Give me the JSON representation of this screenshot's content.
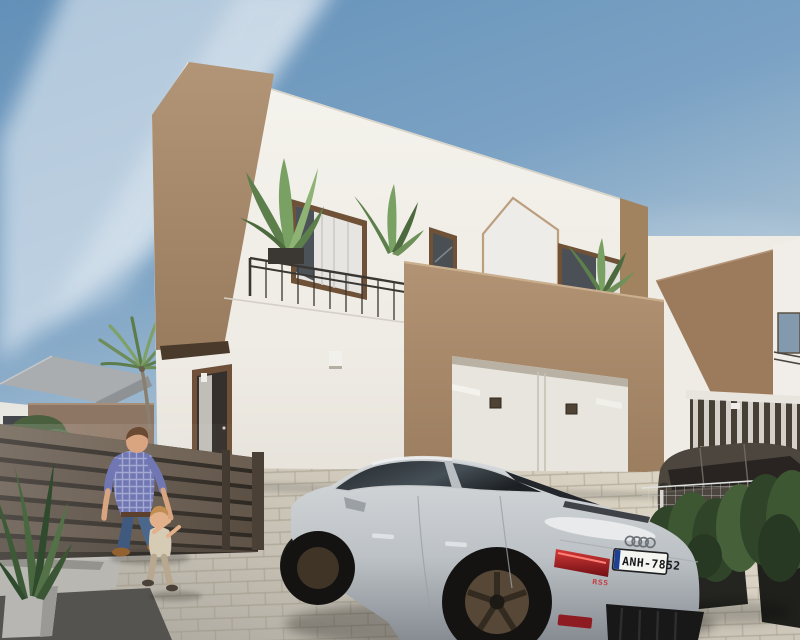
{
  "meta": {
    "title": "Architectural render — new-build two-storey villa with family and car",
    "style": "photoreal 3D exterior visualization"
  },
  "scene": {
    "sky": {
      "top_color": "#6390b8",
      "horizon_color": "#c2d2dc",
      "cloud_color": "#ffffff"
    },
    "main_house": {
      "wall_white": "#f2f0ea",
      "accent_tan": "#ab8e6e",
      "window_frame_brown": "#6f5137",
      "railing_dark": "#3a3631",
      "decor": "pentagon-outline-trim"
    },
    "neighbor_house": {
      "accent_tan": "#9b7b5c",
      "wall_white": "#efece6",
      "garage_slats": "#ddd9d2"
    },
    "left_background": {
      "roof_gray": "#a9adaf",
      "boundary_wall_brown": "#8d7664",
      "palm_green": "#72905e"
    },
    "slat_fence": {
      "slat_color": "#63564a",
      "gap_color": "#2e2822"
    },
    "driveway": {
      "paver_color": "#c6c0b4",
      "joint_color": "#9b958a",
      "sunlit_color": "#dcd3c2"
    },
    "car": {
      "make_logo": "audi-four-rings",
      "model_badge": "RS5",
      "plate": "ANH-7852",
      "plate_colors": {
        "background": "#f4f4f1",
        "text": "#17181a",
        "eu_strip": "#1d3f94"
      },
      "body_color": "#c7cbce",
      "glass_color": "#2b3034",
      "taillight_color": "#b01f26",
      "wheel_color": "#564737"
    },
    "suv": {
      "body_color": "#4c463f"
    },
    "people": {
      "man": {
        "shirt": "#7077b2",
        "jeans": "#4b688c",
        "shoes": "#93602f"
      },
      "child": {
        "top": "#d6cbb4",
        "pants": "#b7a88f"
      }
    },
    "plants": {
      "leaf_green": "#5d7f4c",
      "hedge_green": "#3d5733",
      "planter_black": "#242420"
    }
  }
}
